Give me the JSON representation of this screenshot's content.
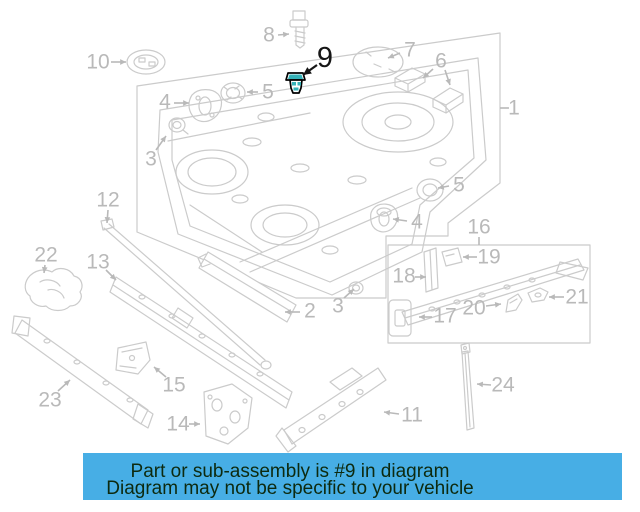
{
  "banner": {
    "line1": "Part or sub-assembly is #9 in diagram",
    "line2": "Diagram may not be specific to your vehicle",
    "bg_color": "#47aee5",
    "text_color": "#0d2a0f"
  },
  "diagram": {
    "highlighted_part": "9",
    "colors": {
      "line": "#cbcbcb",
      "label": "#b9b9b9",
      "highlight": "#161616",
      "part_outline": "#000000",
      "part_accent": "#35b2b8"
    },
    "labels": [
      {
        "text": "1",
        "x": 514,
        "y": 108,
        "arrows": [
          {
            "x1": 509,
            "y1": 108,
            "x2": 500,
            "y2": 108,
            "head": false
          }
        ]
      },
      {
        "text": "2",
        "x": 310,
        "y": 311,
        "arrows": [
          {
            "x1": 300,
            "y1": 312,
            "x2": 285,
            "y2": 312,
            "head": true
          }
        ]
      },
      {
        "text": "3",
        "x": 151,
        "y": 159,
        "arrows": [
          {
            "x1": 156,
            "y1": 150,
            "x2": 166,
            "y2": 136,
            "head": true
          }
        ]
      },
      {
        "text": "3",
        "x": 338,
        "y": 306,
        "arrows": [
          {
            "x1": 344,
            "y1": 298,
            "x2": 354,
            "y2": 289,
            "head": true
          }
        ]
      },
      {
        "text": "4",
        "x": 165,
        "y": 102,
        "arrows": [
          {
            "x1": 174,
            "y1": 103,
            "x2": 189,
            "y2": 103,
            "head": true
          }
        ]
      },
      {
        "text": "4",
        "x": 417,
        "y": 222,
        "arrows": [
          {
            "x1": 407,
            "y1": 221,
            "x2": 393,
            "y2": 219,
            "head": true
          }
        ]
      },
      {
        "text": "5",
        "x": 268,
        "y": 92,
        "arrows": [
          {
            "x1": 258,
            "y1": 92,
            "x2": 247,
            "y2": 92,
            "head": true
          }
        ]
      },
      {
        "text": "5",
        "x": 459,
        "y": 185,
        "arrows": [
          {
            "x1": 449,
            "y1": 186,
            "x2": 438,
            "y2": 188,
            "head": true
          }
        ]
      },
      {
        "text": "6",
        "x": 441,
        "y": 61,
        "arrows": [
          {
            "x1": 433,
            "y1": 69,
            "x2": 423,
            "y2": 78,
            "head": true
          },
          {
            "x1": 445,
            "y1": 70,
            "x2": 450,
            "y2": 85,
            "head": true
          }
        ]
      },
      {
        "text": "7",
        "x": 410,
        "y": 50,
        "arrows": [
          {
            "x1": 400,
            "y1": 53,
            "x2": 388,
            "y2": 58,
            "head": true
          }
        ]
      },
      {
        "text": "8",
        "x": 269,
        "y": 35,
        "arrows": [
          {
            "x1": 278,
            "y1": 35,
            "x2": 289,
            "y2": 34,
            "head": true
          }
        ]
      },
      {
        "text": "9",
        "x": 325,
        "y": 58,
        "highlight": true,
        "arrows": [
          {
            "x1": 317,
            "y1": 65,
            "x2": 303,
            "y2": 75,
            "head": true
          }
        ]
      },
      {
        "text": "10",
        "x": 98,
        "y": 62,
        "arrows": [
          {
            "x1": 111,
            "y1": 62,
            "x2": 126,
            "y2": 62,
            "head": true
          }
        ]
      },
      {
        "text": "11",
        "x": 412,
        "y": 415,
        "arrows": [
          {
            "x1": 399,
            "y1": 414,
            "x2": 384,
            "y2": 412,
            "head": true
          }
        ]
      },
      {
        "text": "12",
        "x": 108,
        "y": 200,
        "arrows": [
          {
            "x1": 108,
            "y1": 210,
            "x2": 107,
            "y2": 223,
            "head": true
          }
        ]
      },
      {
        "text": "13",
        "x": 98,
        "y": 262,
        "arrows": [
          {
            "x1": 106,
            "y1": 270,
            "x2": 116,
            "y2": 280,
            "head": true
          }
        ]
      },
      {
        "text": "14",
        "x": 178,
        "y": 424,
        "arrows": [
          {
            "x1": 189,
            "y1": 424,
            "x2": 200,
            "y2": 424,
            "head": true
          }
        ]
      },
      {
        "text": "15",
        "x": 174,
        "y": 385,
        "arrows": [
          {
            "x1": 166,
            "y1": 377,
            "x2": 154,
            "y2": 367,
            "head": true
          }
        ]
      },
      {
        "text": "16",
        "x": 479,
        "y": 227,
        "arrows": [
          {
            "x1": 479,
            "y1": 237,
            "x2": 479,
            "y2": 245,
            "head": false
          }
        ]
      },
      {
        "text": "17",
        "x": 445,
        "y": 316,
        "arrows": [
          {
            "x1": 432,
            "y1": 317,
            "x2": 419,
            "y2": 317,
            "head": true
          }
        ]
      },
      {
        "text": "18",
        "x": 404,
        "y": 276,
        "arrows": [
          {
            "x1": 415,
            "y1": 277,
            "x2": 426,
            "y2": 277,
            "head": true
          }
        ]
      },
      {
        "text": "19",
        "x": 489,
        "y": 257,
        "arrows": [
          {
            "x1": 477,
            "y1": 257,
            "x2": 463,
            "y2": 257,
            "head": true
          }
        ]
      },
      {
        "text": "20",
        "x": 474,
        "y": 308,
        "arrows": [
          {
            "x1": 486,
            "y1": 306,
            "x2": 501,
            "y2": 304,
            "head": true
          }
        ]
      },
      {
        "text": "21",
        "x": 577,
        "y": 297,
        "arrows": [
          {
            "x1": 564,
            "y1": 297,
            "x2": 549,
            "y2": 297,
            "head": true
          }
        ]
      },
      {
        "text": "22",
        "x": 46,
        "y": 255,
        "arrows": [
          {
            "x1": 45,
            "y1": 265,
            "x2": 44,
            "y2": 273,
            "head": true
          }
        ]
      },
      {
        "text": "23",
        "x": 50,
        "y": 400,
        "arrows": [
          {
            "x1": 58,
            "y1": 391,
            "x2": 70,
            "y2": 380,
            "head": true
          }
        ]
      },
      {
        "text": "24",
        "x": 503,
        "y": 385,
        "arrows": [
          {
            "x1": 491,
            "y1": 385,
            "x2": 477,
            "y2": 384,
            "head": true
          }
        ]
      }
    ]
  }
}
